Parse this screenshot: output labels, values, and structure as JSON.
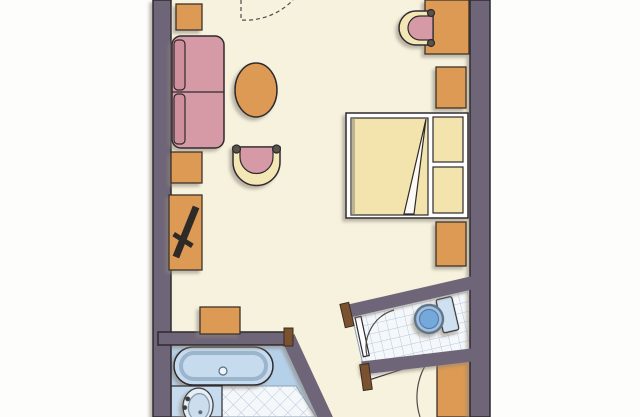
{
  "meta": {
    "kind": "hand-drawn-floor-plan",
    "subject": "hotel-room-with-bathroom-and-wc"
  },
  "colors": {
    "page": "#fdfdfb",
    "floor": "#f7f2de",
    "wall": "#6e6579",
    "wood": "#dd9a54",
    "upholstery": "#d69aa6",
    "cushion": "#cf8f9c",
    "chair_back": "#f3e7b5",
    "bed_frame": "#ffffff",
    "bed_linen": "#f2e4ac",
    "bath_panel": "#b5d1ea",
    "tub_fill": "#c6dbee",
    "basin_fill": "#e7eef5",
    "tile": "#f5f8fb",
    "toilet_tank": "#cfe0f0",
    "toilet_bowl": "#74a9dc",
    "door_leaf": "#ffffff",
    "jamb": "#7a5230",
    "tv": "#2f2b28"
  },
  "rooms": [
    "main-room",
    "bathroom",
    "wc",
    "entry"
  ],
  "furniture": [
    "side-table",
    "sofa",
    "coffee-table",
    "armchair",
    "tv-sideboard",
    "television",
    "luggage-stool",
    "desk",
    "desk-chair",
    "nightstand",
    "double-bed",
    "pillow",
    "wardrobe"
  ],
  "fixtures": [
    "bathtub",
    "washbasin",
    "toilet"
  ],
  "doors": [
    "balcony-door-swing",
    "wc-door",
    "entry-door"
  ]
}
